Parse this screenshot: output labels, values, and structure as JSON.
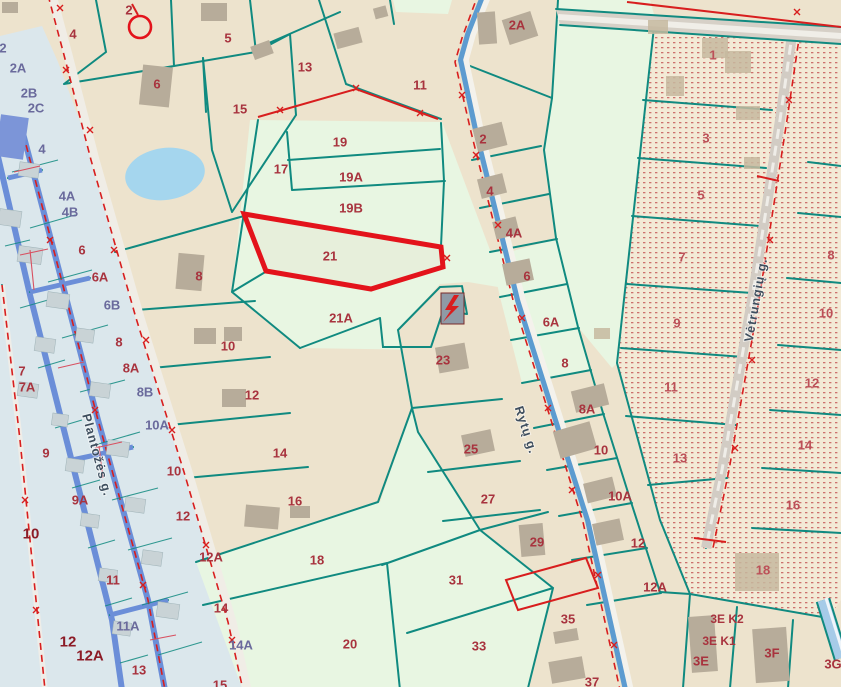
{
  "map": {
    "type": "cadastral-parcel-map",
    "selected_parcel": {
      "number": "21",
      "outline_color": "#E3131B"
    },
    "streets": [
      {
        "name": "Plantožės g.",
        "x": 97,
        "y": 455,
        "rotation": 75
      },
      {
        "name": "Rytų g.",
        "x": 526,
        "y": 430,
        "rotation": 72
      },
      {
        "name": "Vėtrungių g.",
        "x": 756,
        "y": 300,
        "rotation": -80
      }
    ],
    "symbols": [
      {
        "name": "transformer-lightning",
        "x": 452,
        "y": 308
      },
      {
        "name": "survey-point-circle",
        "x": 140,
        "y": 27
      }
    ],
    "colors": {
      "beige": "#EDE3CD",
      "mint": "#E8F6E2",
      "strip": "#DBE7EC",
      "dotted_base": "#F3EAD6",
      "dot": "#C25252",
      "teal": "#108A80",
      "roadBlue": "#6B8ED8",
      "roadGray": "#D6D0C7",
      "roadWhite": "#F4F2EC",
      "red": "#D81E1E",
      "selected": "#E3131B",
      "label_crimson": "#A8333E",
      "label_purple": "#6A6A9C",
      "label_dotted": "#BC5058",
      "label_bold": "#8C1B26",
      "street_text": "#3E4E5E",
      "building": "#B7AC9A",
      "buildingStrip": "#C9D3D6",
      "pond": "#A5D6EE",
      "transformer": "#8F9AA6"
    },
    "labels": [
      {
        "t": "4",
        "x": 73,
        "y": 34,
        "c": "r"
      },
      {
        "t": "2",
        "x": 129,
        "y": 10,
        "c": "r"
      },
      {
        "t": "5",
        "x": 228,
        "y": 38,
        "c": "r"
      },
      {
        "t": "6",
        "x": 157,
        "y": 84,
        "c": "r"
      },
      {
        "t": "13",
        "x": 305,
        "y": 67,
        "c": "r"
      },
      {
        "t": "15",
        "x": 240,
        "y": 109,
        "c": "r"
      },
      {
        "t": "11",
        "x": 420,
        "y": 85,
        "c": "r"
      },
      {
        "t": "2A",
        "x": 517,
        "y": 25,
        "c": "r"
      },
      {
        "t": "17",
        "x": 281,
        "y": 169,
        "c": "r"
      },
      {
        "t": "19",
        "x": 340,
        "y": 142,
        "c": "r"
      },
      {
        "t": "19A",
        "x": 351,
        "y": 177,
        "c": "r"
      },
      {
        "t": "19B",
        "x": 351,
        "y": 208,
        "c": "r"
      },
      {
        "t": "21",
        "x": 330,
        "y": 256,
        "c": "r"
      },
      {
        "t": "21A",
        "x": 341,
        "y": 318,
        "c": "r"
      },
      {
        "t": "2",
        "x": 483,
        "y": 139,
        "c": "r"
      },
      {
        "t": "4",
        "x": 490,
        "y": 191,
        "c": "r"
      },
      {
        "t": "4A",
        "x": 514,
        "y": 233,
        "c": "r"
      },
      {
        "t": "6",
        "x": 527,
        "y": 276,
        "c": "r"
      },
      {
        "t": "6A",
        "x": 551,
        "y": 322,
        "c": "r"
      },
      {
        "t": "8",
        "x": 565,
        "y": 363,
        "c": "r"
      },
      {
        "t": "8A",
        "x": 587,
        "y": 409,
        "c": "r"
      },
      {
        "t": "10",
        "x": 601,
        "y": 450,
        "c": "r"
      },
      {
        "t": "10A",
        "x": 620,
        "y": 496,
        "c": "r"
      },
      {
        "t": "12",
        "x": 638,
        "y": 543,
        "c": "r"
      },
      {
        "t": "12A",
        "x": 655,
        "y": 587,
        "c": "r"
      },
      {
        "t": "8",
        "x": 199,
        "y": 276,
        "c": "r"
      },
      {
        "t": "10",
        "x": 228,
        "y": 346,
        "c": "r"
      },
      {
        "t": "12",
        "x": 252,
        "y": 395,
        "c": "r"
      },
      {
        "t": "14",
        "x": 280,
        "y": 453,
        "c": "r"
      },
      {
        "t": "16",
        "x": 295,
        "y": 501,
        "c": "r"
      },
      {
        "t": "18",
        "x": 317,
        "y": 560,
        "c": "r"
      },
      {
        "t": "20",
        "x": 350,
        "y": 644,
        "c": "r"
      },
      {
        "t": "23",
        "x": 443,
        "y": 360,
        "c": "r"
      },
      {
        "t": "25",
        "x": 471,
        "y": 449,
        "c": "r"
      },
      {
        "t": "27",
        "x": 488,
        "y": 499,
        "c": "r"
      },
      {
        "t": "29",
        "x": 537,
        "y": 542,
        "c": "r"
      },
      {
        "t": "35",
        "x": 568,
        "y": 619,
        "c": "r"
      },
      {
        "t": "37",
        "x": 592,
        "y": 682,
        "c": "r"
      },
      {
        "t": "31",
        "x": 456,
        "y": 580,
        "c": "r"
      },
      {
        "t": "33",
        "x": 479,
        "y": 646,
        "c": "r"
      },
      {
        "t": "3E K2",
        "x": 727,
        "y": 619,
        "c": "r"
      },
      {
        "t": "3E K1",
        "x": 719,
        "y": 641,
        "c": "r"
      },
      {
        "t": "3E",
        "x": 701,
        "y": 661,
        "c": "r"
      },
      {
        "t": "3F",
        "x": 772,
        "y": 653,
        "c": "r"
      },
      {
        "t": "3G",
        "x": 833,
        "y": 664,
        "c": "r"
      },
      {
        "t": "1",
        "x": 713,
        "y": 55,
        "c": "d"
      },
      {
        "t": "3",
        "x": 706,
        "y": 138,
        "c": "d"
      },
      {
        "t": "5",
        "x": 701,
        "y": 195,
        "c": "d"
      },
      {
        "t": "7",
        "x": 682,
        "y": 257,
        "c": "d"
      },
      {
        "t": "9",
        "x": 677,
        "y": 323,
        "c": "d"
      },
      {
        "t": "11",
        "x": 671,
        "y": 387,
        "c": "d"
      },
      {
        "t": "13",
        "x": 680,
        "y": 458,
        "c": "d"
      },
      {
        "t": "8",
        "x": 831,
        "y": 255,
        "c": "d"
      },
      {
        "t": "10",
        "x": 826,
        "y": 313,
        "c": "d"
      },
      {
        "t": "12",
        "x": 812,
        "y": 383,
        "c": "d"
      },
      {
        "t": "14",
        "x": 805,
        "y": 445,
        "c": "d"
      },
      {
        "t": "16",
        "x": 793,
        "y": 505,
        "c": "d"
      },
      {
        "t": "18",
        "x": 763,
        "y": 570,
        "c": "d"
      },
      {
        "t": "2",
        "x": 3,
        "y": 48,
        "c": "p"
      },
      {
        "t": "2A",
        "x": 18,
        "y": 68,
        "c": "p"
      },
      {
        "t": "2B",
        "x": 29,
        "y": 93,
        "c": "p"
      },
      {
        "t": "2C",
        "x": 36,
        "y": 108,
        "c": "p"
      },
      {
        "t": "4",
        "x": 42,
        "y": 149,
        "c": "p"
      },
      {
        "t": "4A",
        "x": 67,
        "y": 196,
        "c": "p"
      },
      {
        "t": "4B",
        "x": 70,
        "y": 212,
        "c": "p"
      },
      {
        "t": "6B",
        "x": 112,
        "y": 305,
        "c": "p"
      },
      {
        "t": "8B",
        "x": 145,
        "y": 392,
        "c": "p"
      },
      {
        "t": "10A",
        "x": 157,
        "y": 425,
        "c": "p"
      },
      {
        "t": "11A",
        "x": 128,
        "y": 626,
        "c": "p"
      },
      {
        "t": "14A",
        "x": 241,
        "y": 645,
        "c": "p"
      },
      {
        "t": "6",
        "x": 82,
        "y": 250,
        "c": "r"
      },
      {
        "t": "6A",
        "x": 100,
        "y": 277,
        "c": "r"
      },
      {
        "t": "8",
        "x": 119,
        "y": 342,
        "c": "r"
      },
      {
        "t": "8A",
        "x": 131,
        "y": 368,
        "c": "r"
      },
      {
        "t": "7",
        "x": 22,
        "y": 371,
        "c": "r"
      },
      {
        "t": "7A",
        "x": 27,
        "y": 387,
        "c": "r"
      },
      {
        "t": "9",
        "x": 46,
        "y": 453,
        "c": "r"
      },
      {
        "t": "9A",
        "x": 80,
        "y": 500,
        "c": "r"
      },
      {
        "t": "10",
        "x": 174,
        "y": 471,
        "c": "r"
      },
      {
        "t": "12",
        "x": 183,
        "y": 516,
        "c": "r"
      },
      {
        "t": "12A",
        "x": 211,
        "y": 557,
        "c": "r"
      },
      {
        "t": "11",
        "x": 113,
        "y": 580,
        "c": "r"
      },
      {
        "t": "13",
        "x": 139,
        "y": 670,
        "c": "r"
      },
      {
        "t": "14",
        "x": 221,
        "y": 608,
        "c": "r"
      },
      {
        "t": "15",
        "x": 220,
        "y": 685,
        "c": "r"
      },
      {
        "t": "10",
        "x": 31,
        "y": 534,
        "c": "b"
      },
      {
        "t": "12",
        "x": 68,
        "y": 642,
        "c": "b"
      },
      {
        "t": "12A",
        "x": 90,
        "y": 656,
        "c": "b"
      }
    ]
  }
}
